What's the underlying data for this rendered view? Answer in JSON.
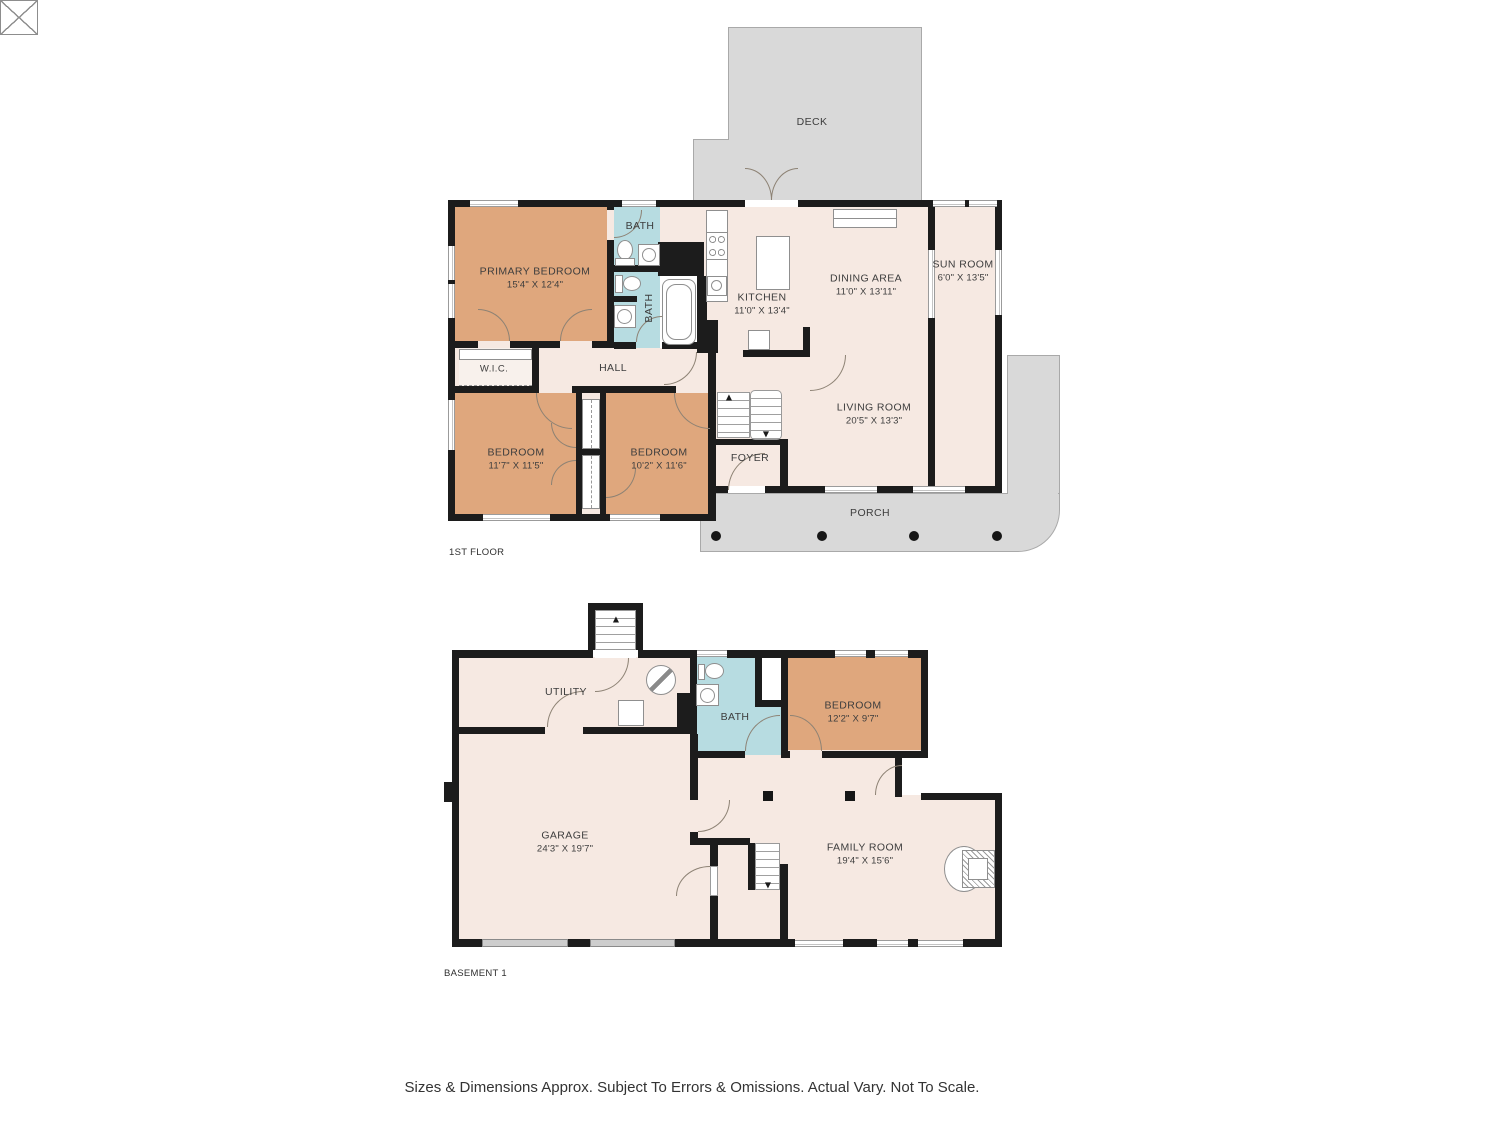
{
  "meta": {
    "disclaimer": "Sizes & Dimensions Approx. Subject To Errors & Omissions. Actual Vary. Not To Scale.",
    "colors": {
      "floor": "#f6e9e2",
      "bedroom_fill": "#dfa77d",
      "bath_fill": "#b7dce1",
      "deck_porch_fill": "#d9d9d9",
      "wall": "#1c1c1c"
    }
  },
  "floor1": {
    "tag": "1ST FLOOR",
    "rooms": {
      "primary_bedroom": {
        "name": "PRIMARY BEDROOM",
        "dims": "15'4\" X 12'4\""
      },
      "bath_top": {
        "name": "BATH"
      },
      "bath_main": {
        "name": "BATH"
      },
      "kitchen": {
        "name": "KITCHEN",
        "dims": "11'0\" X 13'4\""
      },
      "dining_area": {
        "name": "DINING AREA",
        "dims": "11'0\" X 13'11\""
      },
      "sun_room": {
        "name": "SUN ROOM",
        "dims": "6'0\" X 13'5\""
      },
      "wic": {
        "name": "W.I.C."
      },
      "hall": {
        "name": "HALL"
      },
      "bedroom_left": {
        "name": "BEDROOM",
        "dims": "11'7\" X 11'5\""
      },
      "bedroom_right": {
        "name": "BEDROOM",
        "dims": "10'2\" X 11'6\""
      },
      "foyer": {
        "name": "FOYER"
      },
      "living_room": {
        "name": "LIVING ROOM",
        "dims": "20'5\" X 13'3\""
      },
      "deck": {
        "name": "DECK"
      },
      "porch": {
        "name": "PORCH"
      }
    }
  },
  "basement": {
    "tag": "BASEMENT 1",
    "rooms": {
      "utility": {
        "name": "UTILITY"
      },
      "bath": {
        "name": "BATH"
      },
      "bedroom": {
        "name": "BEDROOM",
        "dims": "12'2\" X 9'7\""
      },
      "garage": {
        "name": "GARAGE",
        "dims": "24'3\" X 19'7\""
      },
      "family_room": {
        "name": "FAMILY ROOM",
        "dims": "19'4\" X 15'6\""
      }
    }
  },
  "icons": {
    "arrow_up": "▲",
    "arrow_down": "▼"
  }
}
